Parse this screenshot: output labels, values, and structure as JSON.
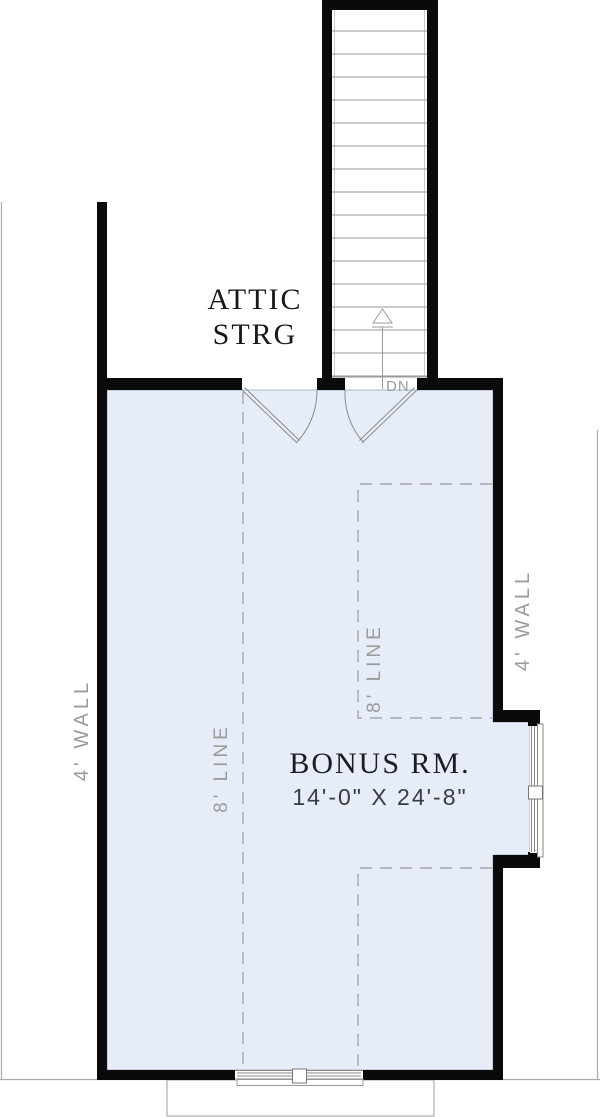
{
  "labels": {
    "attic_room_line1": "ATTIC",
    "attic_room_line2": "STRG",
    "stair_down": "DN",
    "room_name": "BONUS RM.",
    "room_dimensions": "14'-0\" X 24'-8\"",
    "left_wall_height": "4' WALL",
    "right_wall_height": "4' WALL",
    "left_ceiling_line": "8' LINE",
    "right_ceiling_line": "8' LINE"
  },
  "colors": {
    "wall_black": "#0a0a0a",
    "floor_fill_blue": "#e7edf8",
    "annotation_gray": "#9b9b9b",
    "drawing_line_gray": "#8a8a8a",
    "text_dark": "#1c1c22"
  }
}
